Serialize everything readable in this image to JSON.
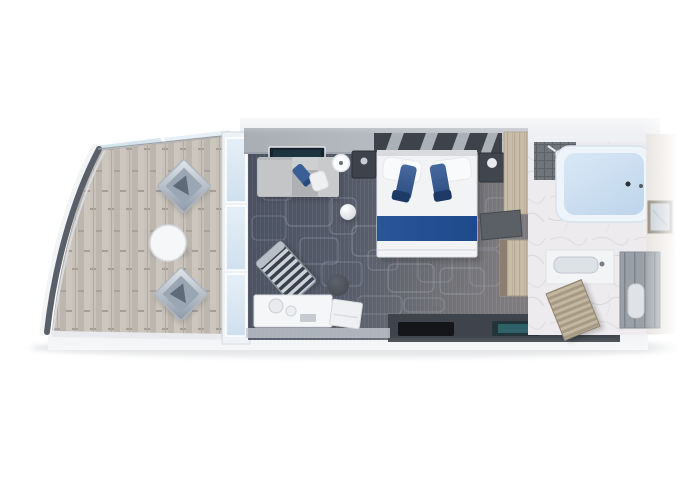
{
  "image": {
    "kind": "stateroom-floorplan-top-view",
    "width": 680,
    "height": 486
  },
  "rooms": {
    "balcony": {
      "label": "balcony",
      "items": [
        "lounge-chair",
        "lounge-chair",
        "round-table"
      ]
    },
    "living": {
      "label": "living-area",
      "items": [
        "sofa-chaise",
        "wall-tv",
        "side-table",
        "sphere-stool",
        "striped-armchair",
        "ottoman",
        "vanity-console",
        "bench"
      ]
    },
    "bedroom": {
      "label": "bedroom",
      "items": [
        "double-bed",
        "nightstand-left",
        "nightstand-right",
        "bed-runner",
        "desk",
        "wardrobe"
      ]
    },
    "bathroom": {
      "label": "bathroom",
      "items": [
        "bathtub",
        "shower-head",
        "wall-art",
        "vanity-sink",
        "toilet-alcove"
      ]
    },
    "entry": {
      "label": "entry-hall",
      "items": [
        "dark-mat",
        "teal-mat",
        "slatted-closet-door"
      ]
    }
  },
  "palette": {
    "background": "#ffffff",
    "carpet_dark": "#49505f",
    "carpet_light": "#7d7b7e",
    "carpet_pattern": "#aab3c2",
    "balcony_wood": "#c7c1ba",
    "railing": "#5a6069",
    "glass": "#cfe0ee",
    "accent_blue": "#3a5e96",
    "runner_blue": "#1e4a8c",
    "sofa_gray": "#b6b8bb",
    "tub_blue": "#d9e8f6",
    "marble": "#edebed",
    "wood_light": "#c9bdaa",
    "wall_gray": "#a9aeb5",
    "dark_floor": "#3f444c"
  }
}
